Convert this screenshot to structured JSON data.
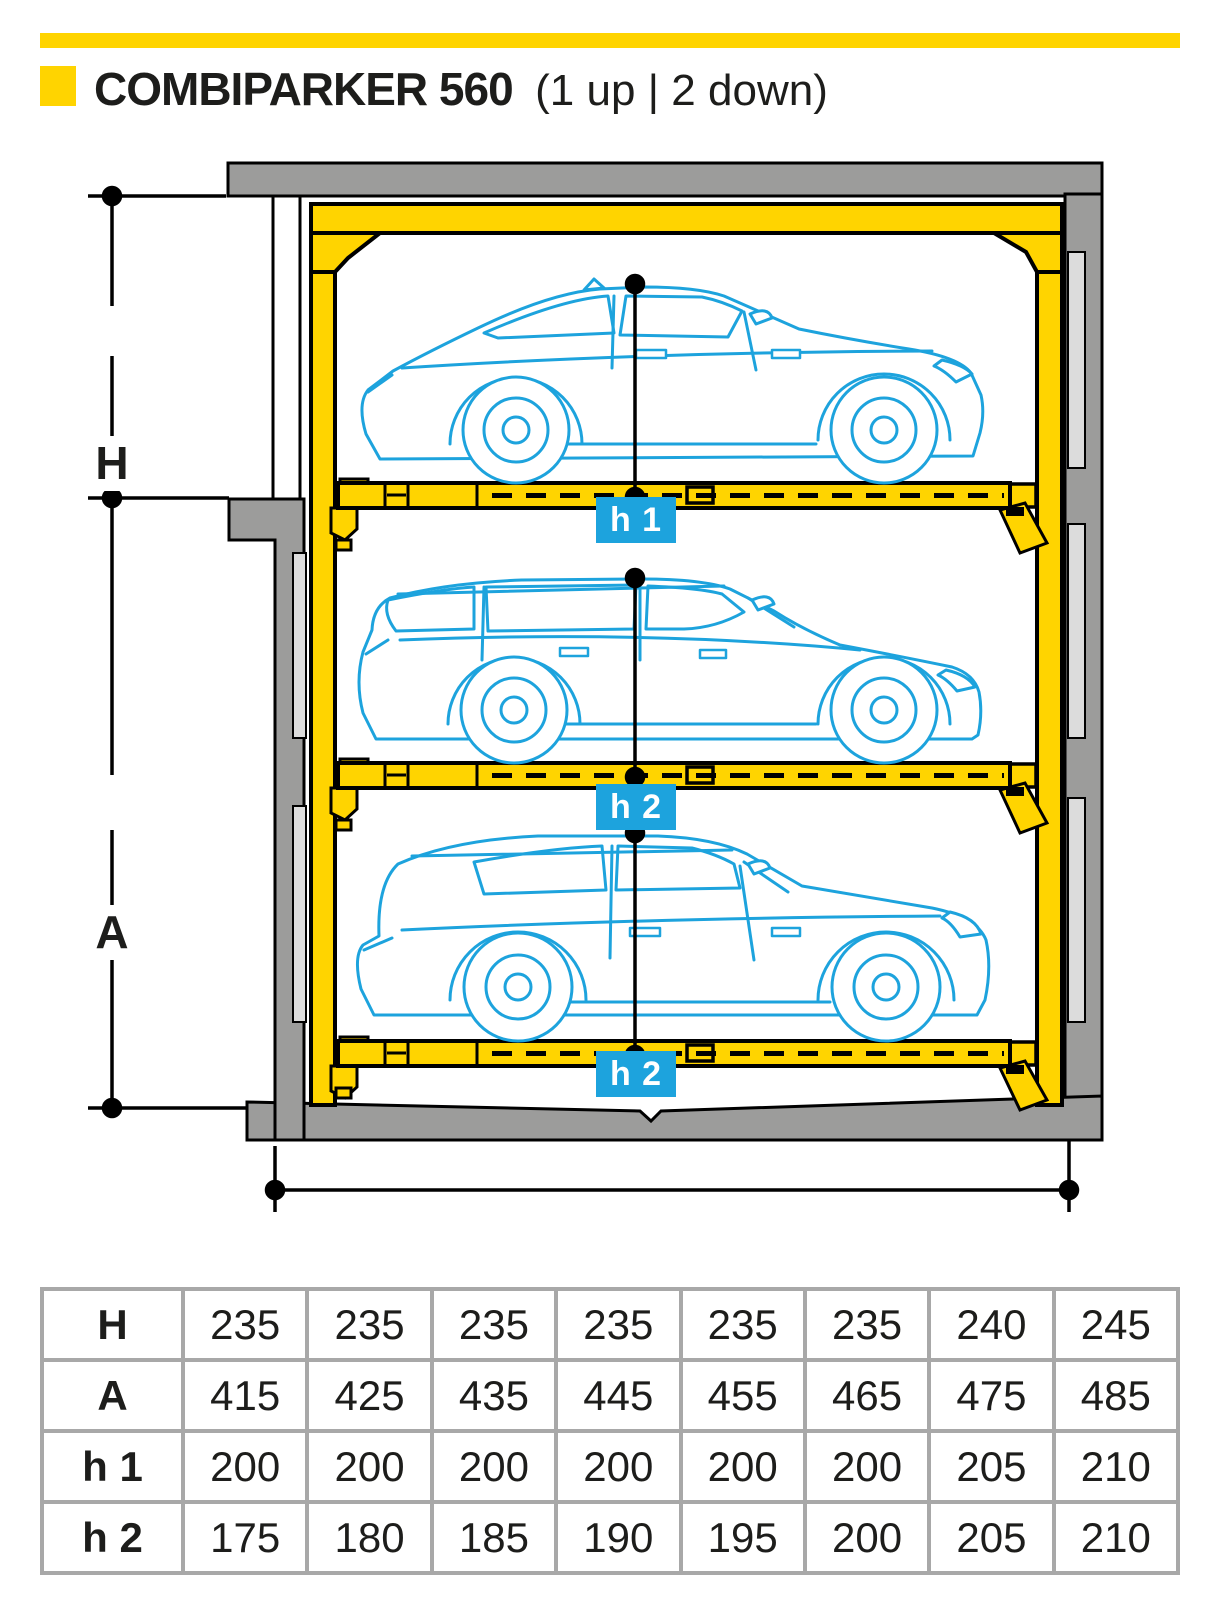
{
  "header": {
    "title": "COMBIPARKER 560",
    "subtitle": "(1 up | 2 down)"
  },
  "diagram": {
    "h_label": "H",
    "a_label": "A",
    "h1_label": "h 1",
    "h2_mid_label": "h 2",
    "h2_bottom_label": "h 2",
    "width_label": "580 (600)"
  },
  "colors": {
    "accent_yellow": "#ffd400",
    "car_blue": "#1da3dd",
    "wall_gray": "#9c9c9b",
    "rail_gray": "#dcdcdc"
  },
  "table": {
    "rows": [
      {
        "label": "H",
        "values": [
          "235",
          "235",
          "235",
          "235",
          "235",
          "235",
          "240",
          "245"
        ]
      },
      {
        "label": "A",
        "values": [
          "415",
          "425",
          "435",
          "445",
          "455",
          "465",
          "475",
          "485"
        ]
      },
      {
        "label": "h 1",
        "values": [
          "200",
          "200",
          "200",
          "200",
          "200",
          "200",
          "205",
          "210"
        ]
      },
      {
        "label": "h 2",
        "values": [
          "175",
          "180",
          "185",
          "190",
          "195",
          "200",
          "205",
          "210"
        ]
      }
    ]
  }
}
